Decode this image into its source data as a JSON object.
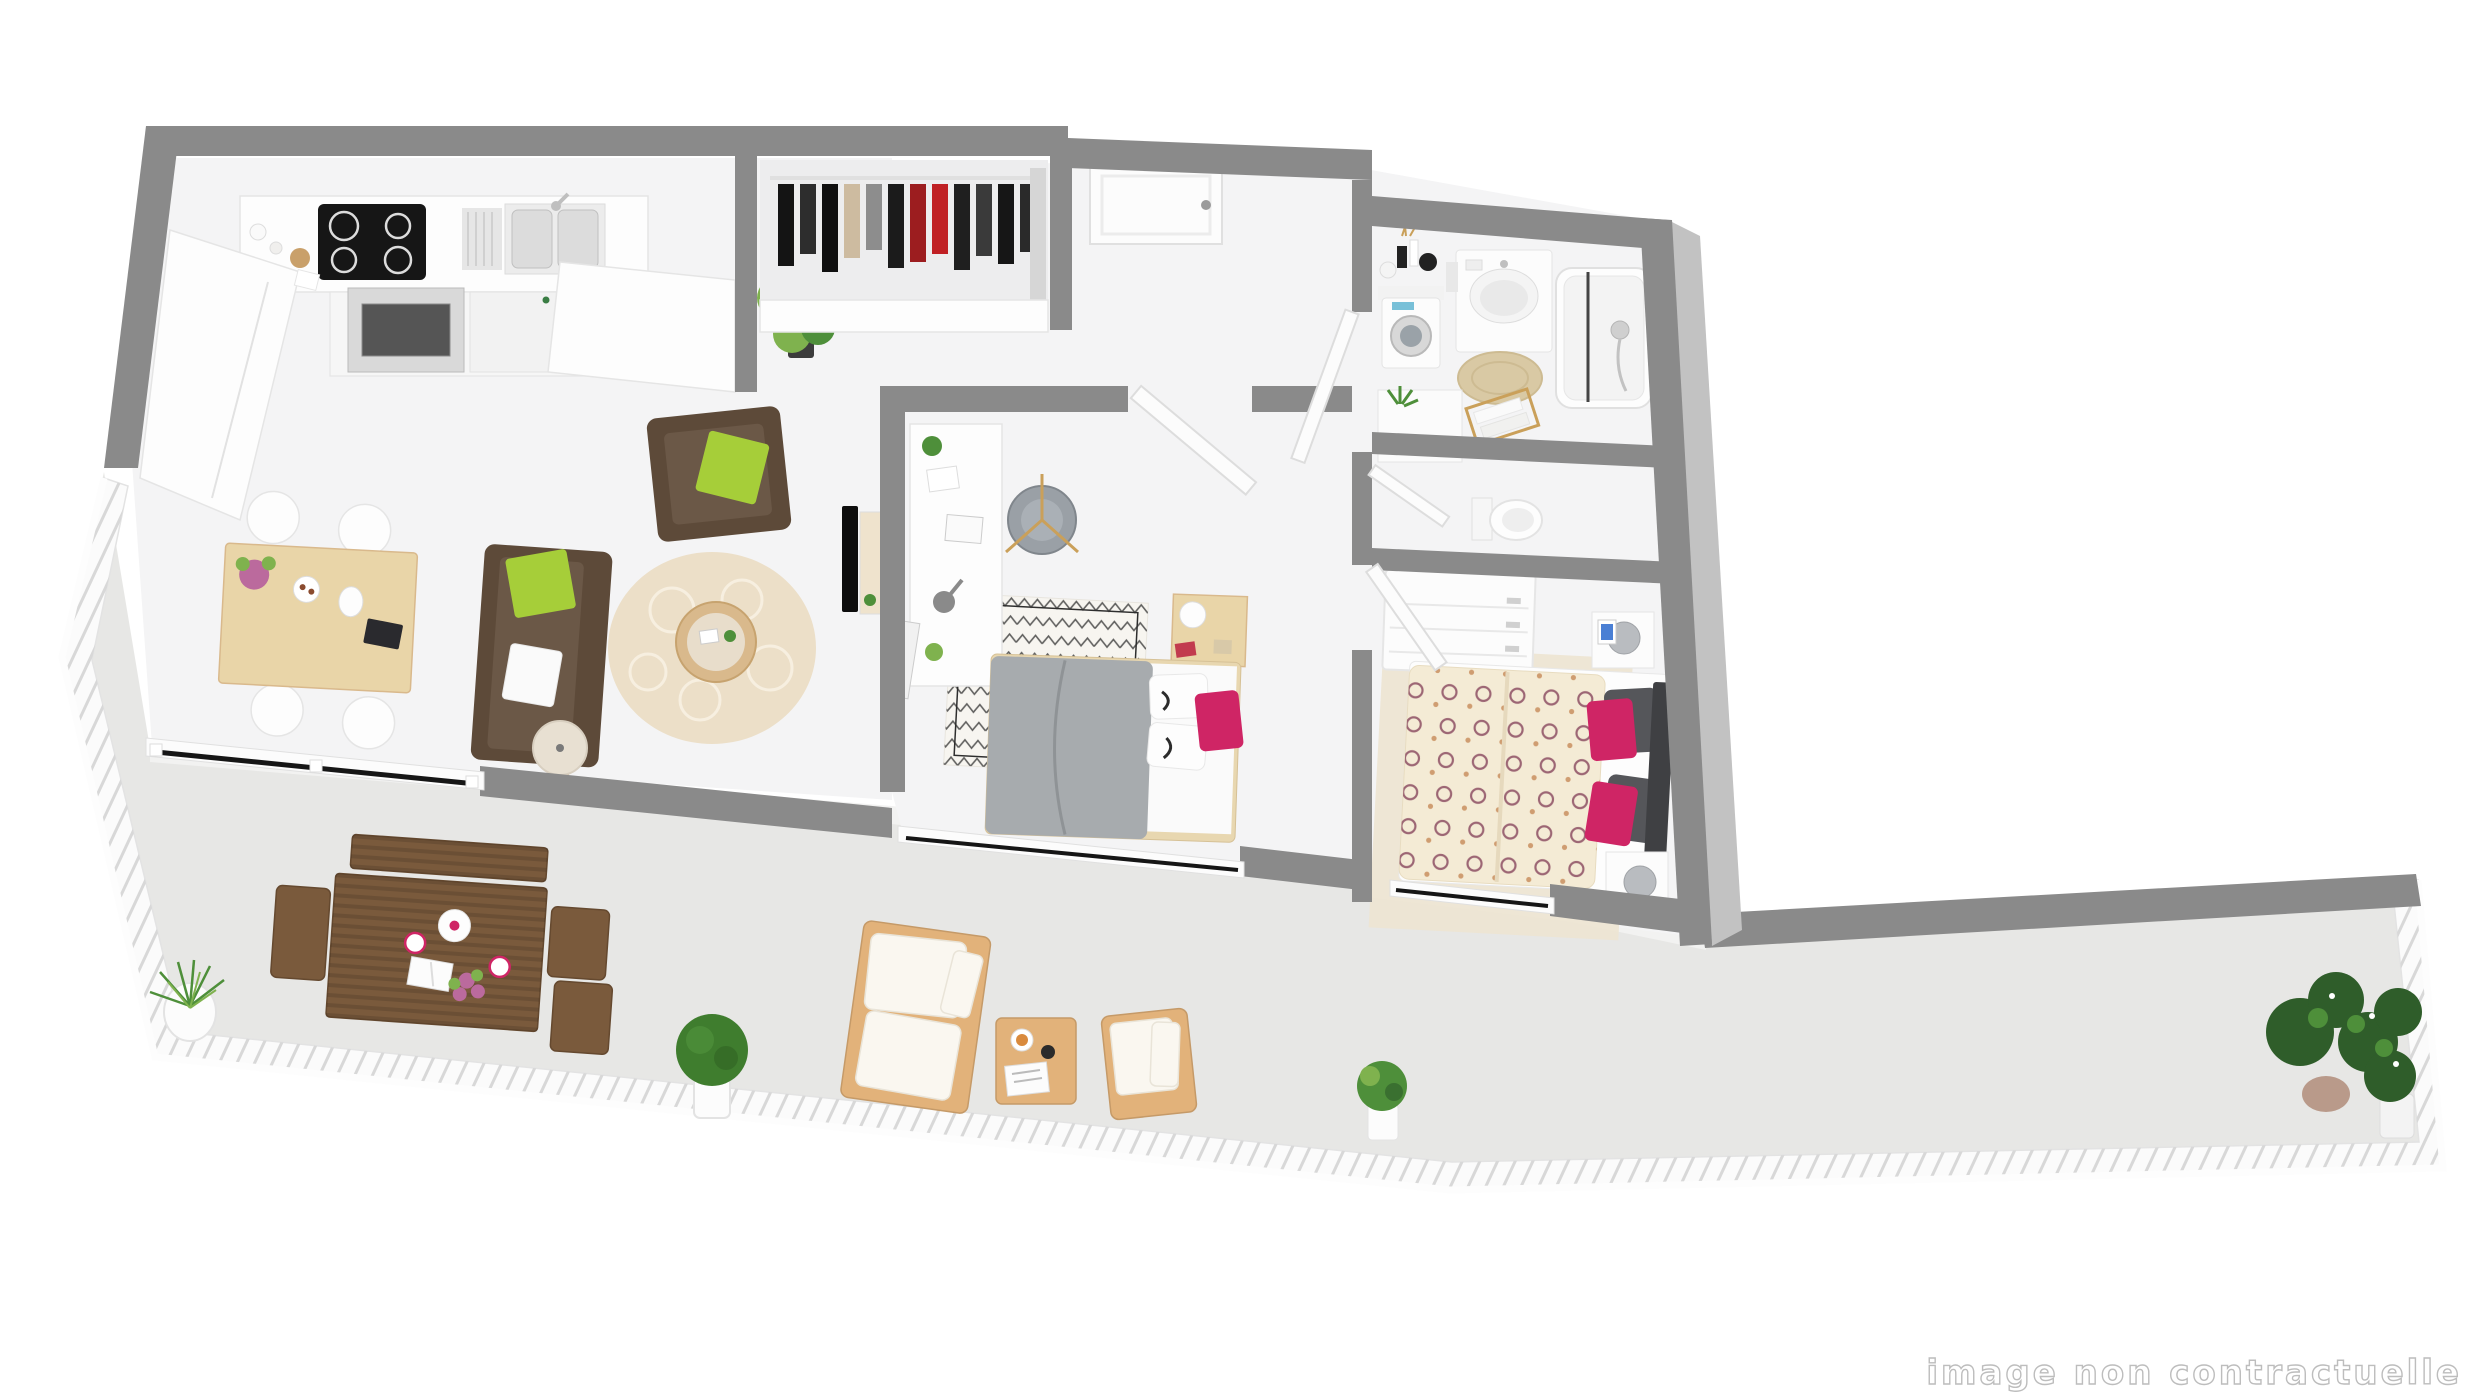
{
  "watermark": {
    "text": "image non contractuelle"
  },
  "palette": {
    "wall": "#8a8a8a",
    "wallFace": "#c2c2c2",
    "floor": "#f4f4f5",
    "floorFace": "#f2f2f1",
    "terrace": "#e7e7e5",
    "railing": "#fbfbfb",
    "railingLine": "#d8d8d8",
    "white": "#fdfdfd",
    "offWhite": "#f6f6f6",
    "lineLight": "#e5e5e5",
    "black": "#161616",
    "steel": "#d9d9d9",
    "woodLight": "#e9d5a8",
    "woodMid": "#d9b98c",
    "woodBrown": "#7a5a3c",
    "woodBrownDark": "#65492f",
    "outdoorWood": "#e2b27a",
    "outdoorWoodEdge": "#c59a68",
    "sofaBrown": "#5d4a39",
    "sofaSeat": "#6b5847",
    "lime": "#a6ce39",
    "magenta": "#cf2565",
    "pinkFlower": "#bb6a9d",
    "plantGreen": "#4e8f3a",
    "plantLight": "#7fb24e",
    "plantDark": "#2f5d2a",
    "grayChair": "#9aa0a6",
    "duvetGray": "#a7abae",
    "duvetGrayEdge": "#8f9396",
    "duvetCream": "#f4ebd5",
    "spiralPlum": "#8d4e63",
    "spiralOrange": "#c98f5f",
    "rugBeige": "#ecdfc8",
    "jute": "#d9c9a4",
    "darkPillow": "#55565a",
    "headboardDark": "#3f4043",
    "tvBlack": "#0d0d0d",
    "watermarkColor": "#bdbdbd"
  }
}
